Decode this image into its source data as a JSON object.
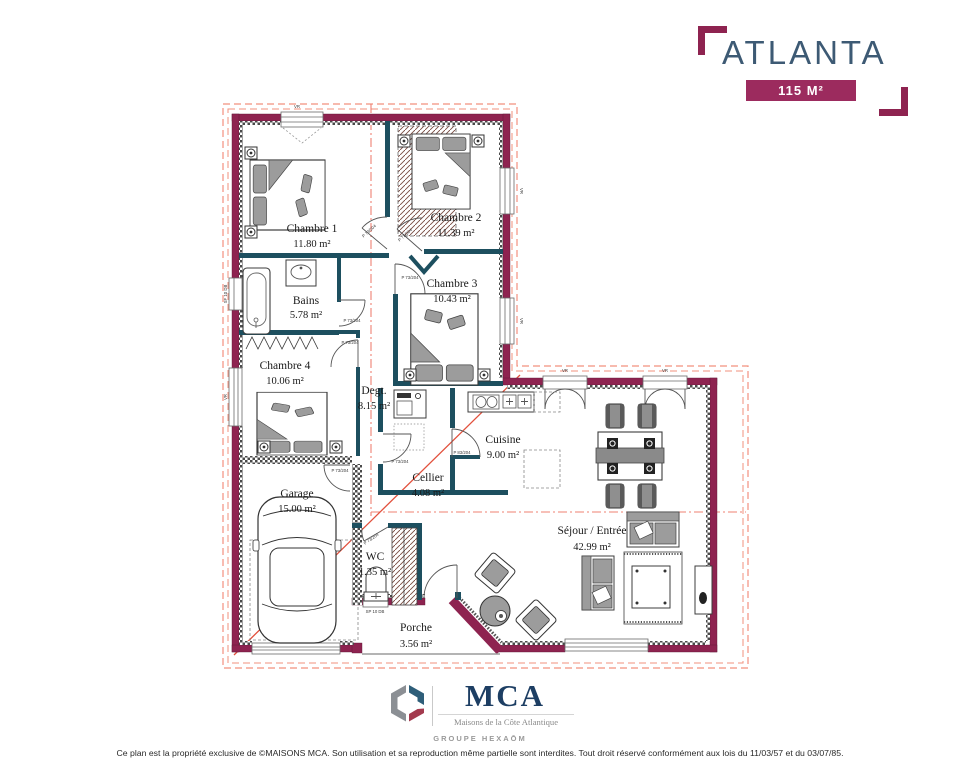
{
  "header": {
    "title": "ATLANTA",
    "area_badge": "115 M²"
  },
  "rooms": [
    {
      "name": "Chambre 1",
      "area": "11.80 m²"
    },
    {
      "name": "Chambre 2",
      "area": "11.39 m²"
    },
    {
      "name": "Chambre 3",
      "area": "10.43 m²"
    },
    {
      "name": "Chambre 4",
      "area": "10.06 m²"
    },
    {
      "name": "Bains",
      "area": "5.78 m²"
    },
    {
      "name": "Degt.",
      "area": "8.15 m²"
    },
    {
      "name": "Cuisine",
      "area": "9.00 m²"
    },
    {
      "name": "Cellier",
      "area": "4.08 m²"
    },
    {
      "name": "Garage",
      "area": "15.00 m²"
    },
    {
      "name": "WC",
      "area": "1.35 m²"
    },
    {
      "name": "Séjour / Entrée",
      "area": "42.99 m²"
    },
    {
      "name": "Porche",
      "area": "3.56 m²"
    }
  ],
  "labels": {
    "door_a": "P 73/204",
    "door_b": "P 83/204",
    "vr": "VR",
    "sf": "SF 10 DB",
    "sp": "SP 10 DB"
  },
  "colors": {
    "wall": "#8e2350",
    "partition": "#1d4f5f",
    "roof_line": "#e8604c",
    "title": "#3d5a74",
    "badge": "#9c2b5e"
  },
  "footer": {
    "brand": "MCA",
    "brand_sub": "Maisons de la Côte Atlantique",
    "group": "GROUPE HEXAŌM",
    "copyright": "Ce plan est la propriété exclusive de ©MAISONS MCA. Son utilisation et sa reproduction même partielle sont interdites. Tout droit réservé conformément aux lois du 11/03/57 et du 03/07/85."
  }
}
